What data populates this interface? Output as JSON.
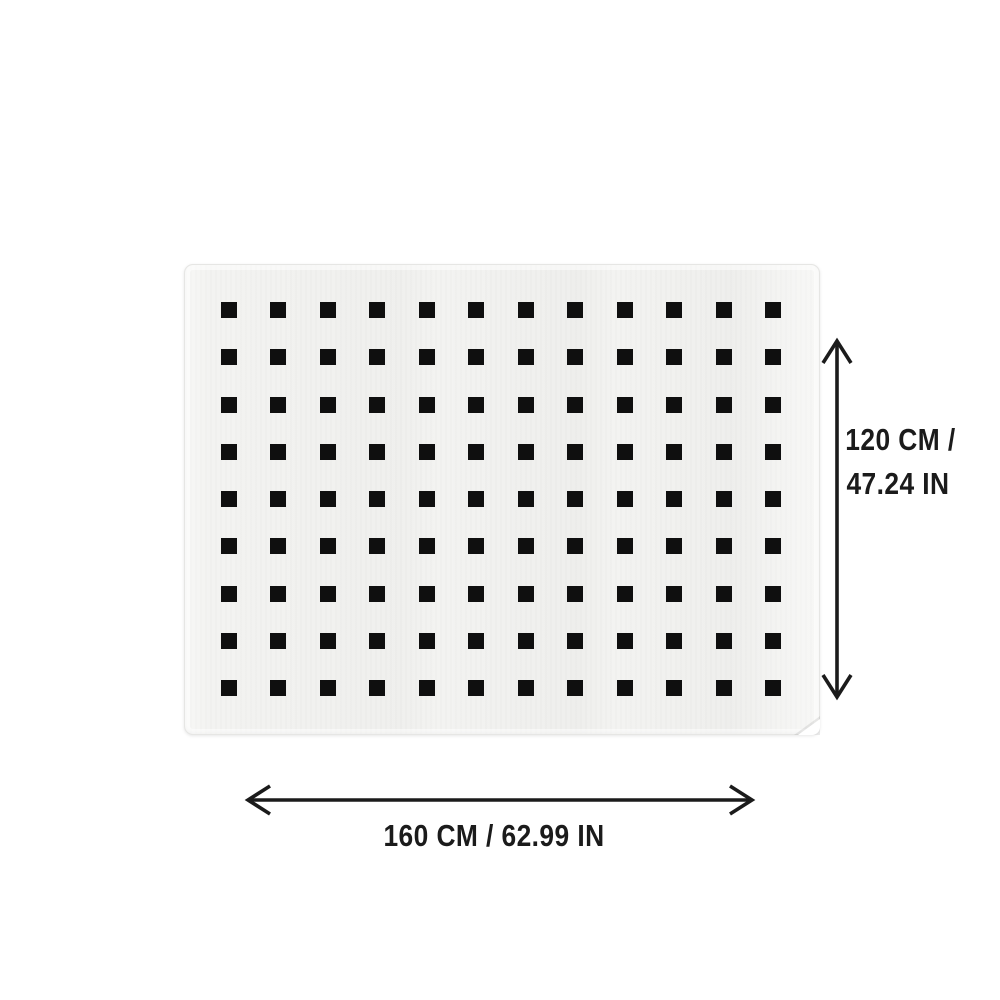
{
  "page": {
    "background_color": "#ffffff",
    "description": "Rug product dimension diagram"
  },
  "rug": {
    "surface_color": "#f3f3f1",
    "border_color": "#e6e6e4",
    "pattern": {
      "shape": "square",
      "color": "#0f0f0f",
      "columns": 12,
      "rows": 9,
      "square_size_px": 16
    }
  },
  "dimensions": {
    "annotation_color": "#1b1b1b",
    "height": {
      "value_cm": 120,
      "value_in": 47.24,
      "label_line1": "120 CM /",
      "label_line2": "47.24 IN"
    },
    "width": {
      "value_cm": 160,
      "value_in": 62.99,
      "label": "160 CM / 62.99 IN"
    }
  }
}
